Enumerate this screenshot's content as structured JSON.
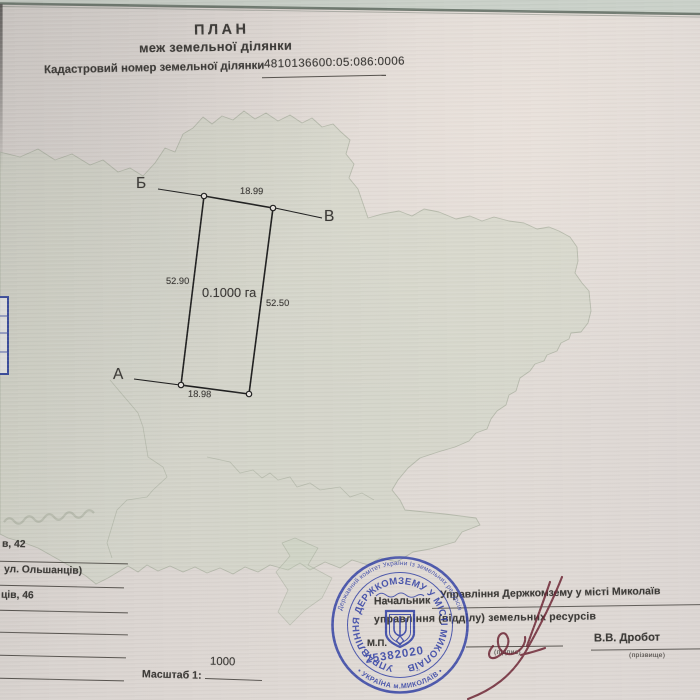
{
  "document": {
    "title": "ПЛАН",
    "subtitle": "меж земельної ділянки",
    "cadastral_label": "Кадастровий номер земельної ділянки",
    "cadastral_number": "4810136600:05:086:0006"
  },
  "plot": {
    "corner_a_label": "А",
    "corner_b_label": "Б",
    "corner_v_label": "В",
    "side_top": "18.99",
    "side_left": "52.90",
    "side_right": "52.50",
    "side_bottom": "18.98",
    "area": "0.1000 га"
  },
  "address_column": {
    "fragment_1": "в, 42",
    "fragment_2": "ул. Ольшанців)",
    "fragment_3": "ців, 46"
  },
  "scale": {
    "label": "Масштаб  1:",
    "value": "1000"
  },
  "approval": {
    "org_line": "Управління Держкомзему у місті Миколаїв",
    "position_line_1": "Начальник",
    "position_line_2": "управління (відділу) земельних ресурсів",
    "signature_caption": "(підпис)",
    "name": "В.В. Дробот",
    "name_caption": "(прізвище)",
    "seal_mark": "М.П."
  },
  "stamp": {
    "ring_top_text": "Державний комітет України Із земельних ресурсів",
    "ring_bottom_text": "•  УКРАЇНА   м.МИКОЛАЇВ  •",
    "inner_ring_text": "УПРАВЛІННЯ ДЕРЖКОМЗЕМУ У МІСТІ МИКОЛАЇВ",
    "number": "25382020"
  },
  "colors": {
    "paper": "#dcd6d2",
    "watermark_green": "#c7d2be",
    "ink_text": "#3b3936",
    "plot_line": "#1f1f1f",
    "stamp_blue": "#2e3da4",
    "signature_maroon": "#6e2635"
  }
}
